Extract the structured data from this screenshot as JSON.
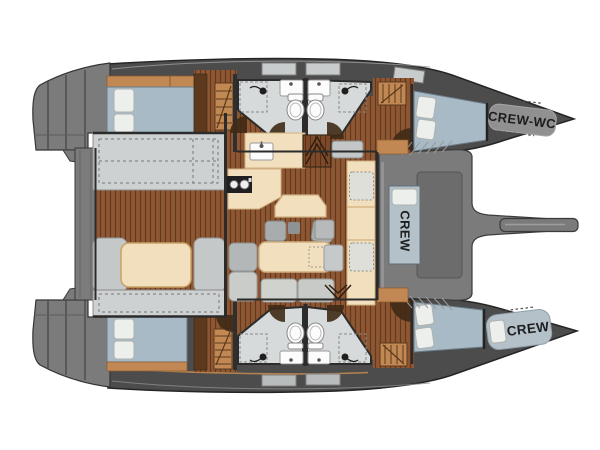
{
  "labels": {
    "crew_wc": "CREW-WC",
    "crew_mid": "CREW",
    "crew_bow": "CREW"
  },
  "colors": {
    "hull": "#4c4c4c",
    "deck": "#7b7b7b",
    "bow_pad": "#909090",
    "wood": "#8a5331",
    "wood_trim": "#c28854",
    "bed": "#a7bac6",
    "crew_pad": "#b4c1c8",
    "bench": "#ced1d1",
    "sofa": "#c5c8c8",
    "cream": "#f2dfbd",
    "bath": "#d7dada",
    "fixture": "#fcfcfc",
    "pillow": "#edefec"
  }
}
